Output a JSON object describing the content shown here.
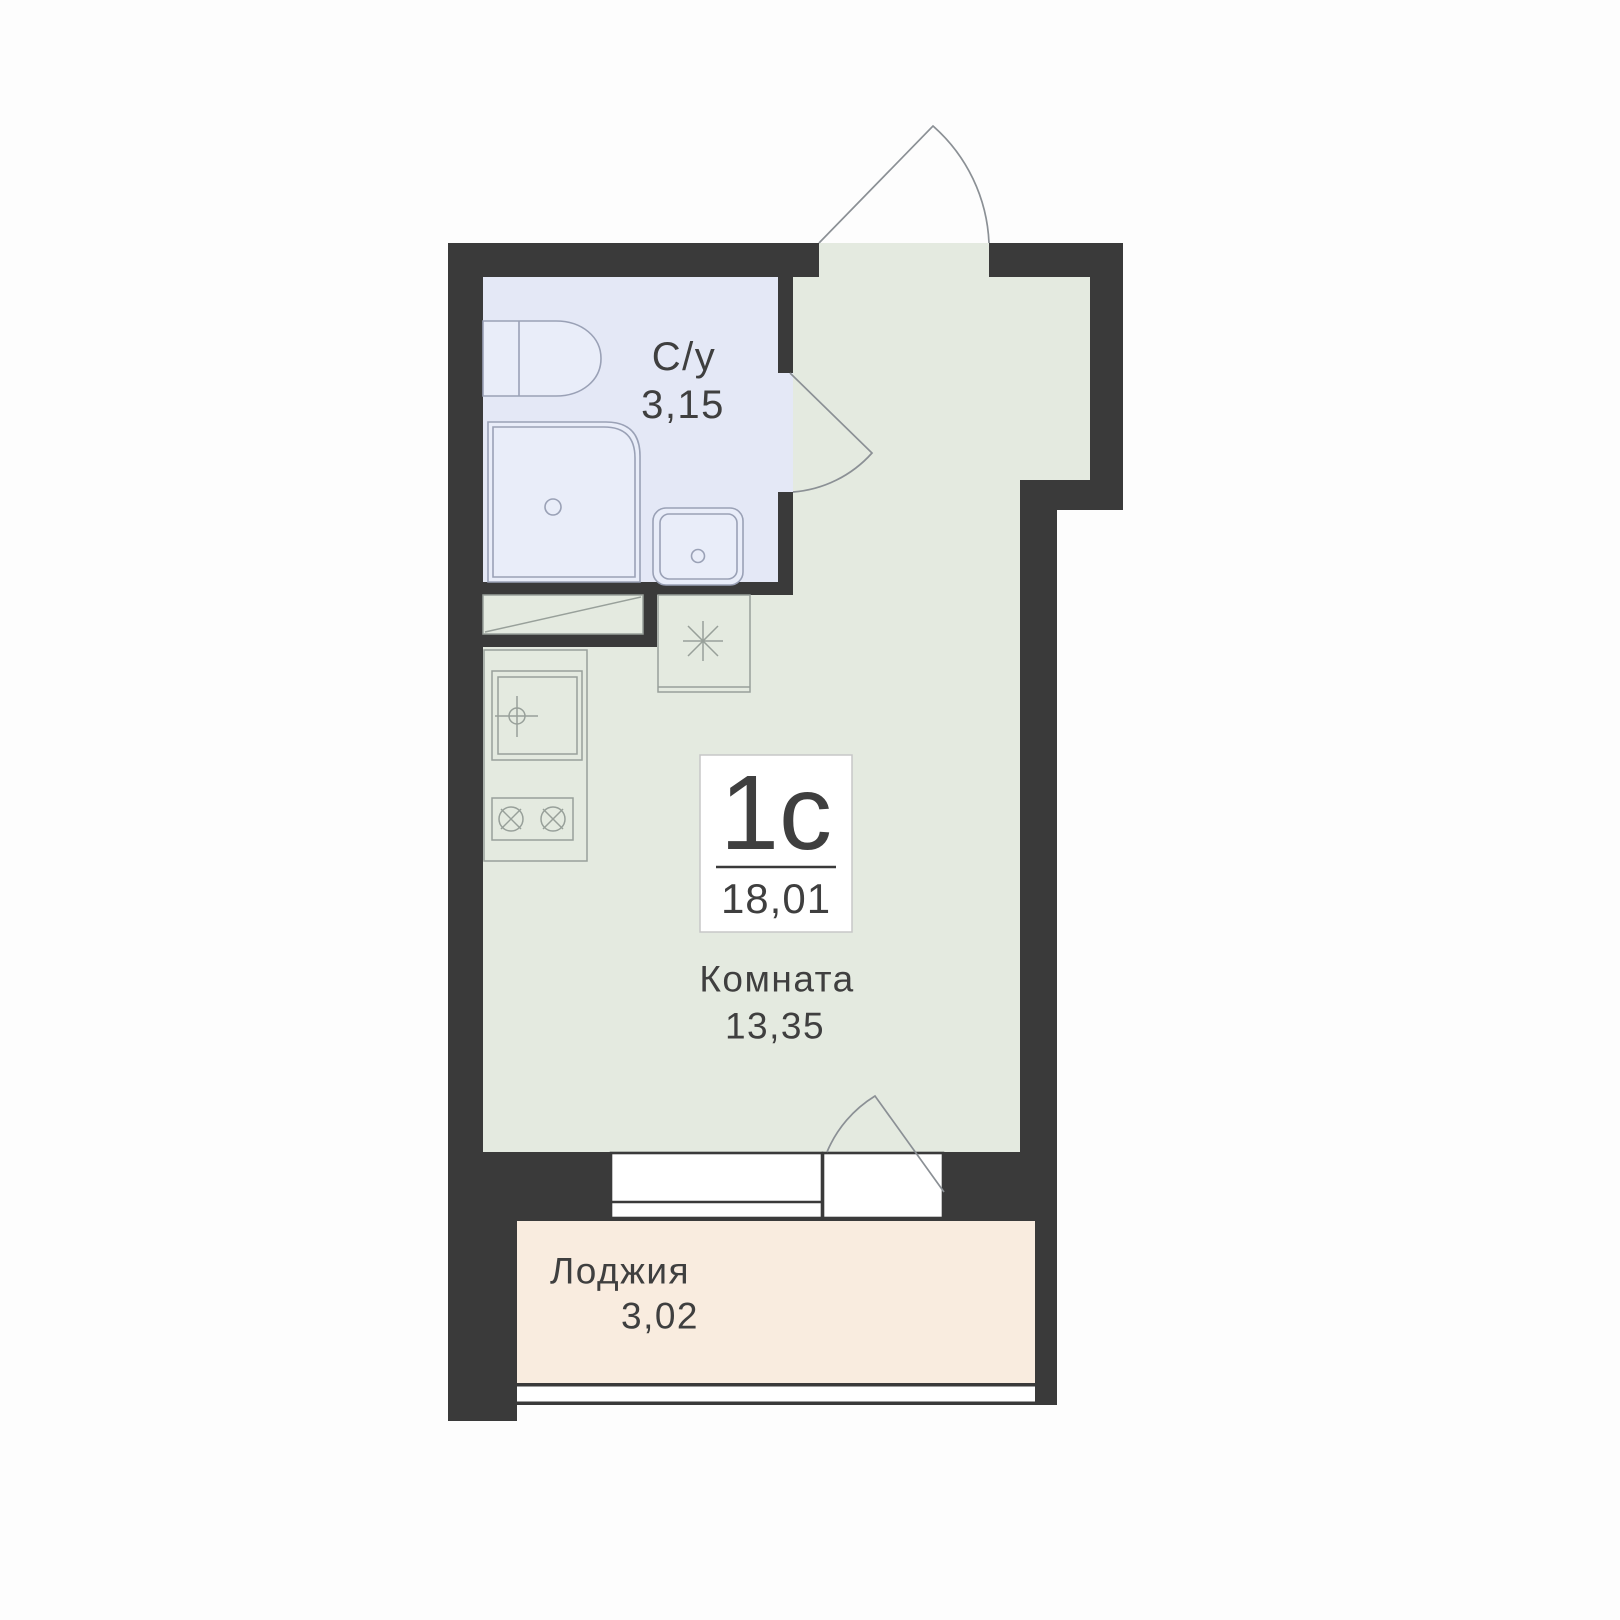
{
  "unit": {
    "type_label": "1с",
    "total_area": "18,01"
  },
  "rooms": {
    "bathroom": {
      "name": "С/у",
      "area": "3,15"
    },
    "living": {
      "name": "Комната",
      "area": "13,35"
    },
    "loggia": {
      "name": "Лоджия",
      "area": "3,02"
    }
  },
  "symbols": {
    "ventilation_duct": "asterisk-8-spoke",
    "duct_shaft": "rect-with-diagonal",
    "door_swing": "quarter-circle-arc",
    "stove_burner": "circle-with-x-cross",
    "sink_tap": "circle-with-crosshair"
  },
  "colors": {
    "wall": "#3a3a3a",
    "room_floor": "#e4eae0",
    "bathroom_floor": "#e4e8f6",
    "loggia_floor": "#f9ecdf",
    "background": "#fdfdfd",
    "text": "#3f3f3f"
  }
}
